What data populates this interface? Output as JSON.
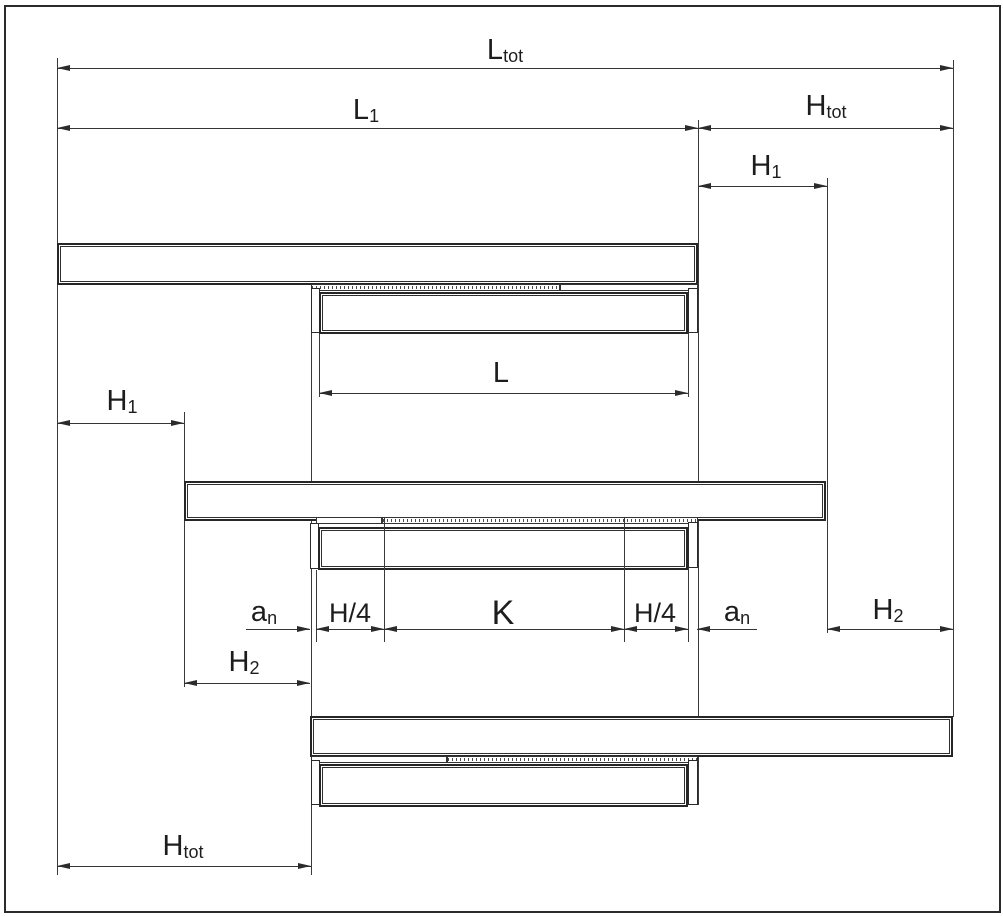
{
  "drawing": {
    "title": "telescopic-slide-extension-dimension-diagram",
    "colors": {
      "line": "#2b2b2b",
      "background": "#ffffff"
    },
    "labels": {
      "l_tot": {
        "base": "L",
        "sub": "tot"
      },
      "l1": {
        "base": "L",
        "sub": "1"
      },
      "h_tot_top": {
        "base": "H",
        "sub": "tot"
      },
      "h1_right": {
        "base": "H",
        "sub": "1"
      },
      "l": {
        "base": "L",
        "sub": ""
      },
      "h1_left": {
        "base": "H",
        "sub": "1"
      },
      "an_left": {
        "base": "a",
        "sub": "n"
      },
      "h4_left": {
        "base": "H/4",
        "sub": ""
      },
      "k": {
        "base": "K",
        "sub": ""
      },
      "h4_right": {
        "base": "H/4",
        "sub": ""
      },
      "an_right": {
        "base": "a",
        "sub": "n"
      },
      "h2_right": {
        "base": "H",
        "sub": "2"
      },
      "h2_left": {
        "base": "H",
        "sub": "2"
      },
      "h_tot_bottom": {
        "base": "H",
        "sub": "tot"
      }
    }
  }
}
